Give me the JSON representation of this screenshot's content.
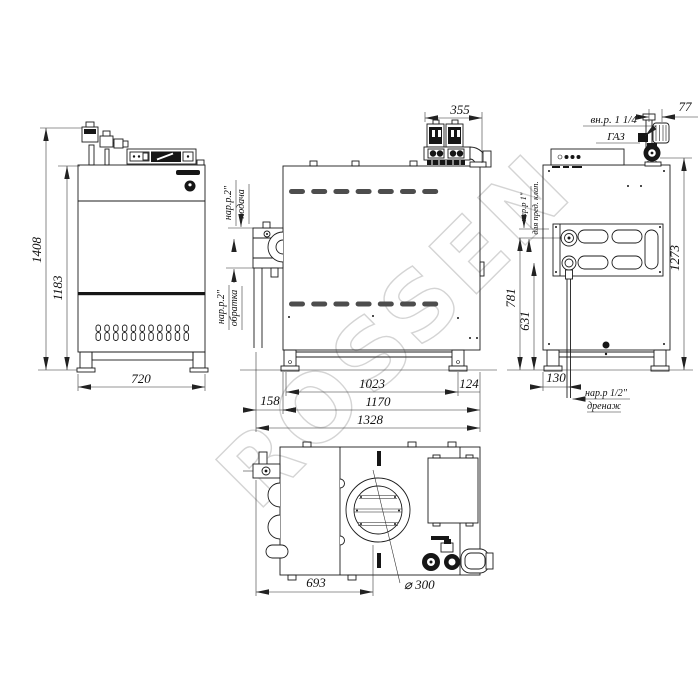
{
  "watermark": "ROSSEN",
  "views": {
    "front": {
      "dims": {
        "total_height": "1408",
        "body_height": "1183",
        "width": "720"
      }
    },
    "side": {
      "dims": {
        "burner_depth": "355",
        "leg_span": "1023",
        "leg_back_offset": "124",
        "flange_offset": "158",
        "body_depth": "1170",
        "total_depth": "1328"
      },
      "ports": {
        "supply_size": "нар.р.2\"",
        "supply_name": "подача",
        "return_size": "нар.р.2\"",
        "return_name": "обратка"
      }
    },
    "rear": {
      "dims": {
        "gas_offset": "77",
        "total_height": "1273",
        "safety_port_height": "781",
        "drain_port_height": "631",
        "drain_offset": "130"
      },
      "labels": {
        "gas_size": "вн.р. 1 1/4\"",
        "gas_name": "ГАЗ",
        "safety_size": "нар.р 1\"",
        "safety_note": "для пред. клап.",
        "drain_size": "нар.р 1/2\"",
        "drain_name": "дренаж"
      }
    },
    "top": {
      "dims": {
        "flue_center_offset": "693",
        "flue_diameter": "⌀ 300"
      }
    }
  }
}
